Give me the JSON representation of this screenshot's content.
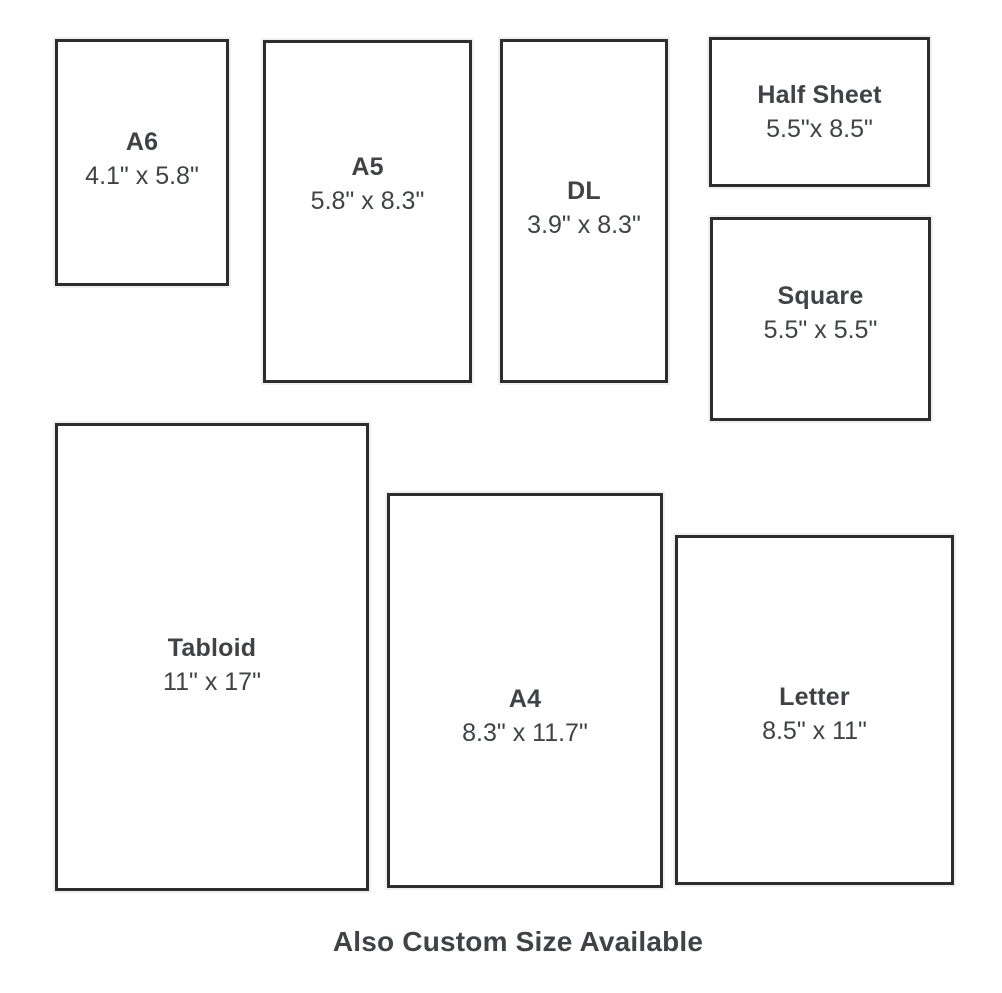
{
  "page": {
    "background": "#ffffff",
    "footer_note": "Also Custom Size Available"
  },
  "colors": {
    "border": "#2d2d2d",
    "text": "#3f4346"
  },
  "sizes": [
    {
      "id": "a6",
      "name": "A6",
      "dimensions": "4.1\" x 5.8\""
    },
    {
      "id": "a5",
      "name": "A5",
      "dimensions": "5.8\" x 8.3\""
    },
    {
      "id": "dl",
      "name": "DL",
      "dimensions": "3.9\" x 8.3\""
    },
    {
      "id": "half-sheet",
      "name": "Half Sheet",
      "dimensions": "5.5\"x 8.5\""
    },
    {
      "id": "square",
      "name": "Square",
      "dimensions": "5.5\" x 5.5\""
    },
    {
      "id": "tabloid",
      "name": "Tabloid",
      "dimensions": "11\" x 17\""
    },
    {
      "id": "a4",
      "name": "A4",
      "dimensions": "8.3\" x 11.7\""
    },
    {
      "id": "letter",
      "name": "Letter",
      "dimensions": "8.5\" x 11\""
    }
  ]
}
